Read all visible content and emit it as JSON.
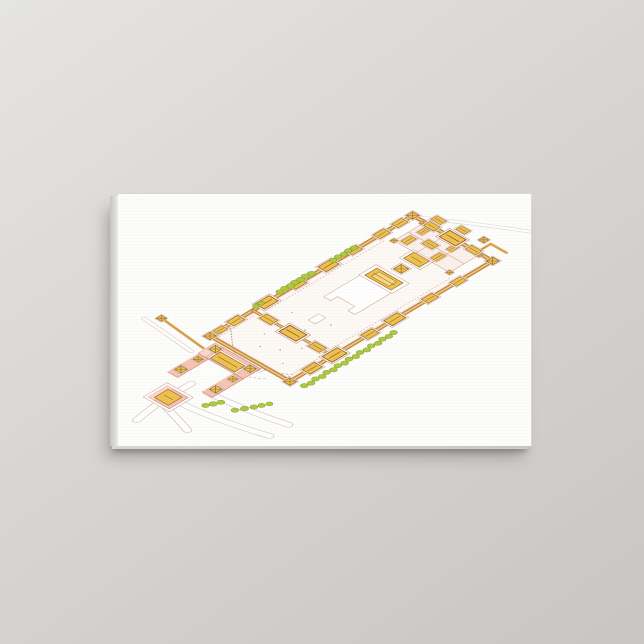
{
  "meta": {
    "alt": "Canvas print hanging on a light gray wall. The canvas shows an isometric watercolor illustration of the Forbidden City imperial palace complex: a long walled rectangle with golden-roofed gates and corner towers, central ceremonial halls on white terraces, an inner court, rows of green trees along the walls, a curved dashed river in the first courtyard, and a U-shaped pink Meridian Gate with a second pink gate and white roads at the lower left."
  },
  "product": {
    "name": "wrapped-canvas-print",
    "orientation": "landscape"
  },
  "illustration": {
    "subject": "imperial-palace-complex-axonometric-watercolor"
  },
  "colors": {
    "bg-top": "#e5e4e2",
    "bg-mid": "#d7d5d3",
    "bg-bottom": "#c8c6c4",
    "canvas-face": "#fdfdfb",
    "side-dark": "#c6c4c1",
    "side-light": "#eceae8",
    "edge-line": "#d9d7d4",
    "shadow-soft": "rgba(96,93,90,0.40)",
    "shadow-hard": "rgba(96,93,90,0.45)",
    "wall-dark": "#bb8038",
    "wall-mid": "#d99f4c",
    "wall-light": "#eec37a",
    "roof-gold": "#eec04f",
    "roof-gold-light": "#f6d87e",
    "roof-edge": "#8a5a20",
    "pink-light": "#f5c4b4",
    "pink-band": "#f9d8cb",
    "pink-mid": "#e8a28d",
    "pink-dark": "#cf8270",
    "line-pink": "#c9a08a",
    "tree-green": "#aec93f",
    "tree-edge": "#7d9a26",
    "road-line": "#c9b098",
    "river": "#b59b86",
    "colonnade": "#e2b6ad",
    "wash-pink": "#fbebe5",
    "wash-warm": "#fdf6ee",
    "speck": "#8a7a6a"
  }
}
